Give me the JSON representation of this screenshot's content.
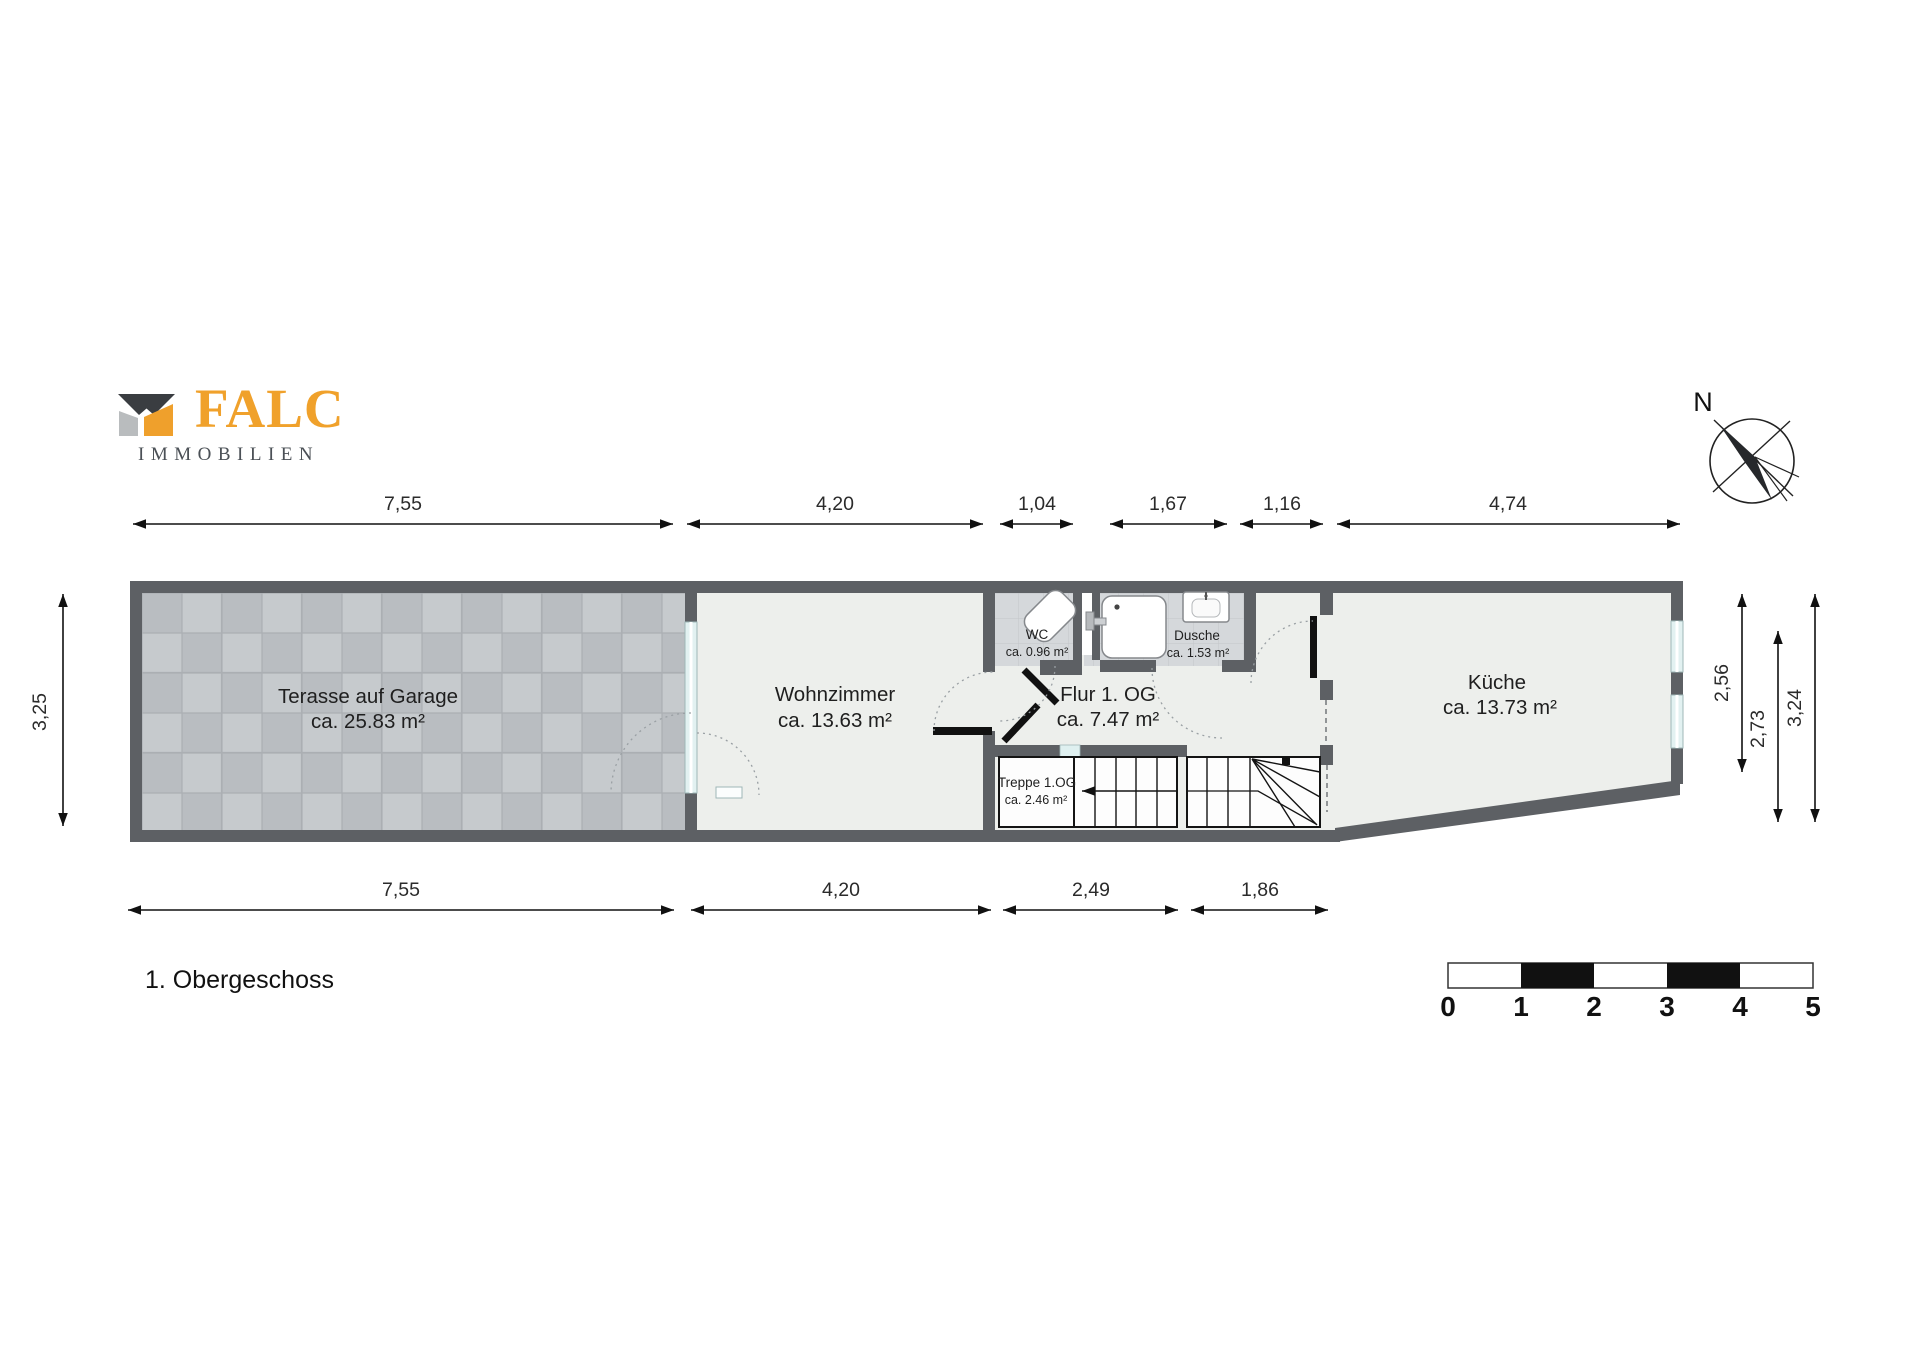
{
  "branding": {
    "logo_text": "FALC",
    "logo_subtext": "IMMOBILIEN"
  },
  "title": "1. Obergeschoss",
  "compass": {
    "label": "N"
  },
  "rooms": {
    "terrace": {
      "name": "Terasse auf Garage",
      "area": "ca. 25.83 m²"
    },
    "living": {
      "name": "Wohnzimmer",
      "area": "ca. 13.63 m²"
    },
    "wc": {
      "name": "WC",
      "area": "ca. 0.96 m²"
    },
    "shower": {
      "name": "Dusche",
      "area": "ca. 1.53 m²"
    },
    "hall": {
      "name": "Flur 1.  OG",
      "area": "ca. 7.47 m²"
    },
    "stairs": {
      "name": "Treppe 1.OG",
      "area": "ca. 2.46 m²"
    },
    "kitchen": {
      "name": "Küche",
      "area": "ca. 13.73 m²"
    }
  },
  "dimensions": {
    "top": [
      "7,55",
      "4,20",
      "1,04",
      "1,67",
      "1,16",
      "4,74"
    ],
    "bottom": [
      "7,55",
      "4,20",
      "2,49",
      "1,86"
    ],
    "left": [
      "3,25"
    ],
    "right": [
      "2,56",
      "2,73",
      "3,24"
    ]
  },
  "scale_bar": {
    "ticks": [
      "0",
      "1",
      "2",
      "3",
      "4",
      "5"
    ]
  },
  "colors": {
    "wall": "#5d6064",
    "room": "#edefec",
    "brand_orange": "#f0a12b",
    "glass": "#e2f1f1"
  }
}
